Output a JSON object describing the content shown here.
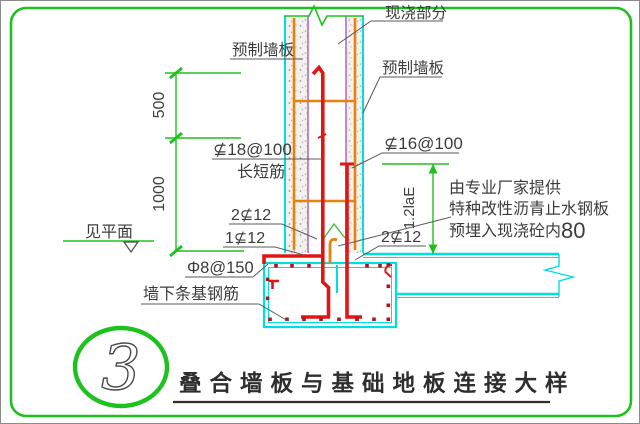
{
  "drawing": {
    "kind": "construction-detail",
    "colors": {
      "frame_green": "#1ec21e",
      "concrete_outline_cyan": "#00dede",
      "rebar_red": "#e01515",
      "panel_rebar_orange": "#e8820c",
      "panel_inner_line_purple": "#b76bb8",
      "dimension_green": "#1ec21e",
      "label_text": "#3c3c3c"
    },
    "labels": {
      "cast_in_place": "现浇部分",
      "precast_wall_left": "预制墙板",
      "precast_wall_right": "预制墙板",
      "wall_vertical_rebar": "⊈18@100",
      "wall_vertical_rebar_note": "长短筋",
      "starter_rebar": "⊈16@100",
      "waterstop_note_line1": "由专业厂家提供",
      "waterstop_note_line2": "特种改性沥青止水钢板",
      "waterstop_note_line3": "预埋入现浇砼内",
      "waterstop_embed_depth": "80",
      "top_bars_left": "2⊈12",
      "middle_bar": "1⊈12",
      "joint_bars_right": "2⊈12",
      "foundation_stirrup": "Φ8@150",
      "strip_foundation_rebar": "墙下条基钢筋",
      "ground_reference": "见平面"
    },
    "dimensions": {
      "upper_segment": "500",
      "lower_segment": "1000",
      "anchorage_length": "1.2laE"
    },
    "title_block": {
      "detail_number": "3",
      "title": "叠合墙板与基础地板连接大样"
    }
  }
}
